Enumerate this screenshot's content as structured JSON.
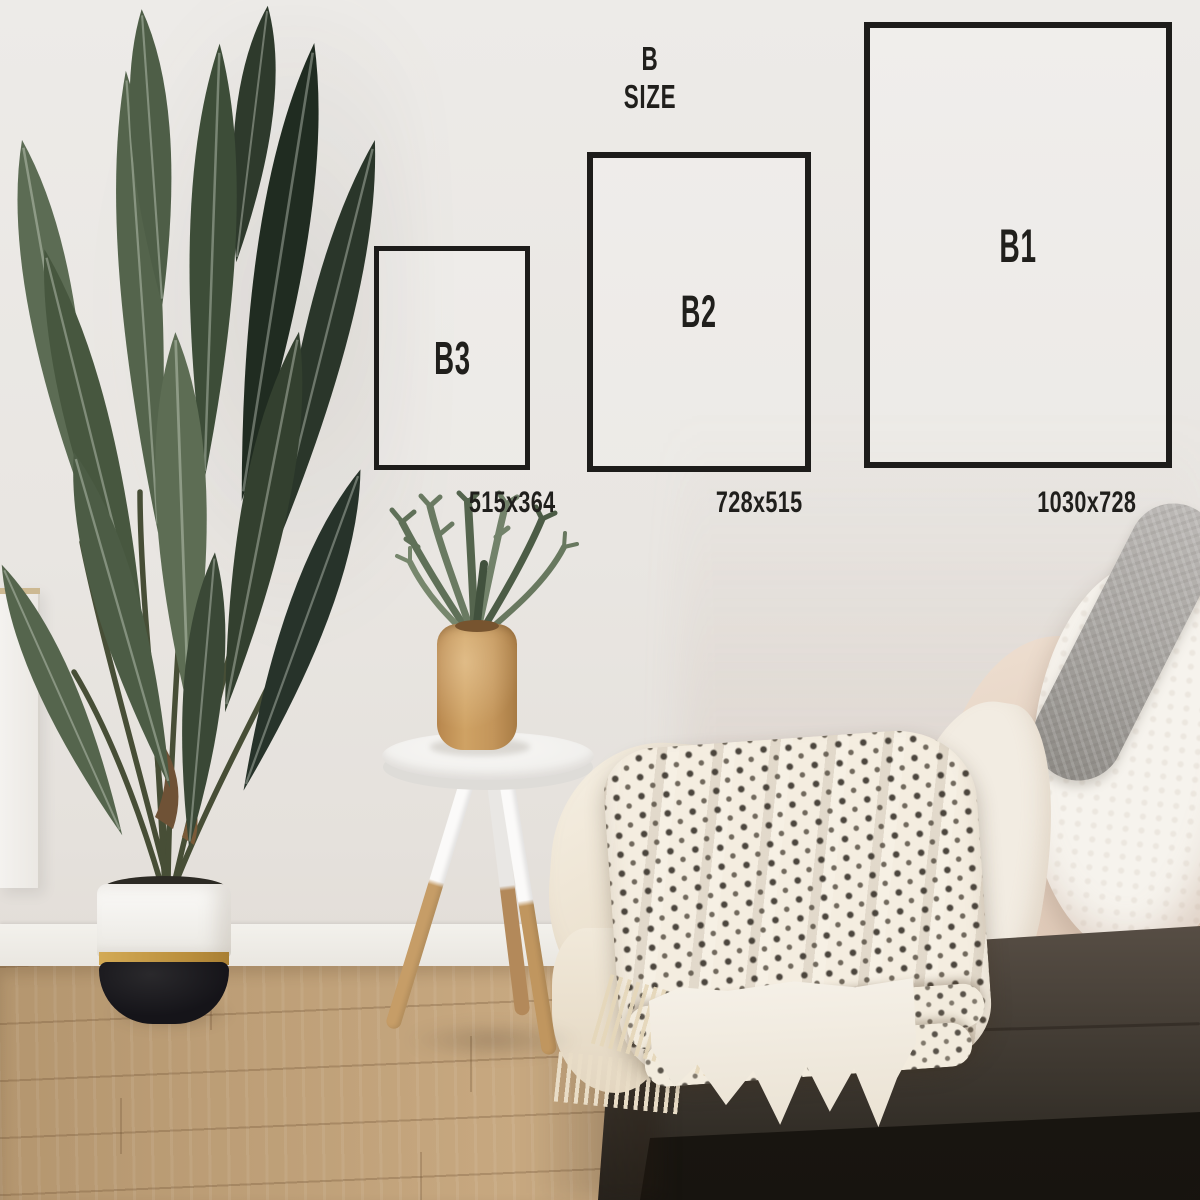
{
  "overlay": {
    "title": "B SIZE",
    "line_color": "#1d1c1a",
    "text_color": "#201f1c",
    "boxes": [
      {
        "label": "B3",
        "dimensions": "515x364"
      },
      {
        "label": "B2",
        "dimensions": "728x515"
      },
      {
        "label": "B1",
        "dimensions": "1030x728"
      }
    ]
  },
  "scene": {
    "wall_color": "#e9e6e2",
    "floor_color": "#c6a77f",
    "pot_accent_color": "#c29a47",
    "elements": [
      "white-wall",
      "wood-floor",
      "baseboard",
      "white-cabinet",
      "bird-of-paradise-plant",
      "two-tone-planter-pot",
      "round-tripod-side-table",
      "wooden-vase",
      "staghorn-fern",
      "gray-couch",
      "patterned-throw-blanket",
      "cream-fringed-blanket",
      "white-sherpa-pillow",
      "gray-knit-cushion"
    ]
  }
}
